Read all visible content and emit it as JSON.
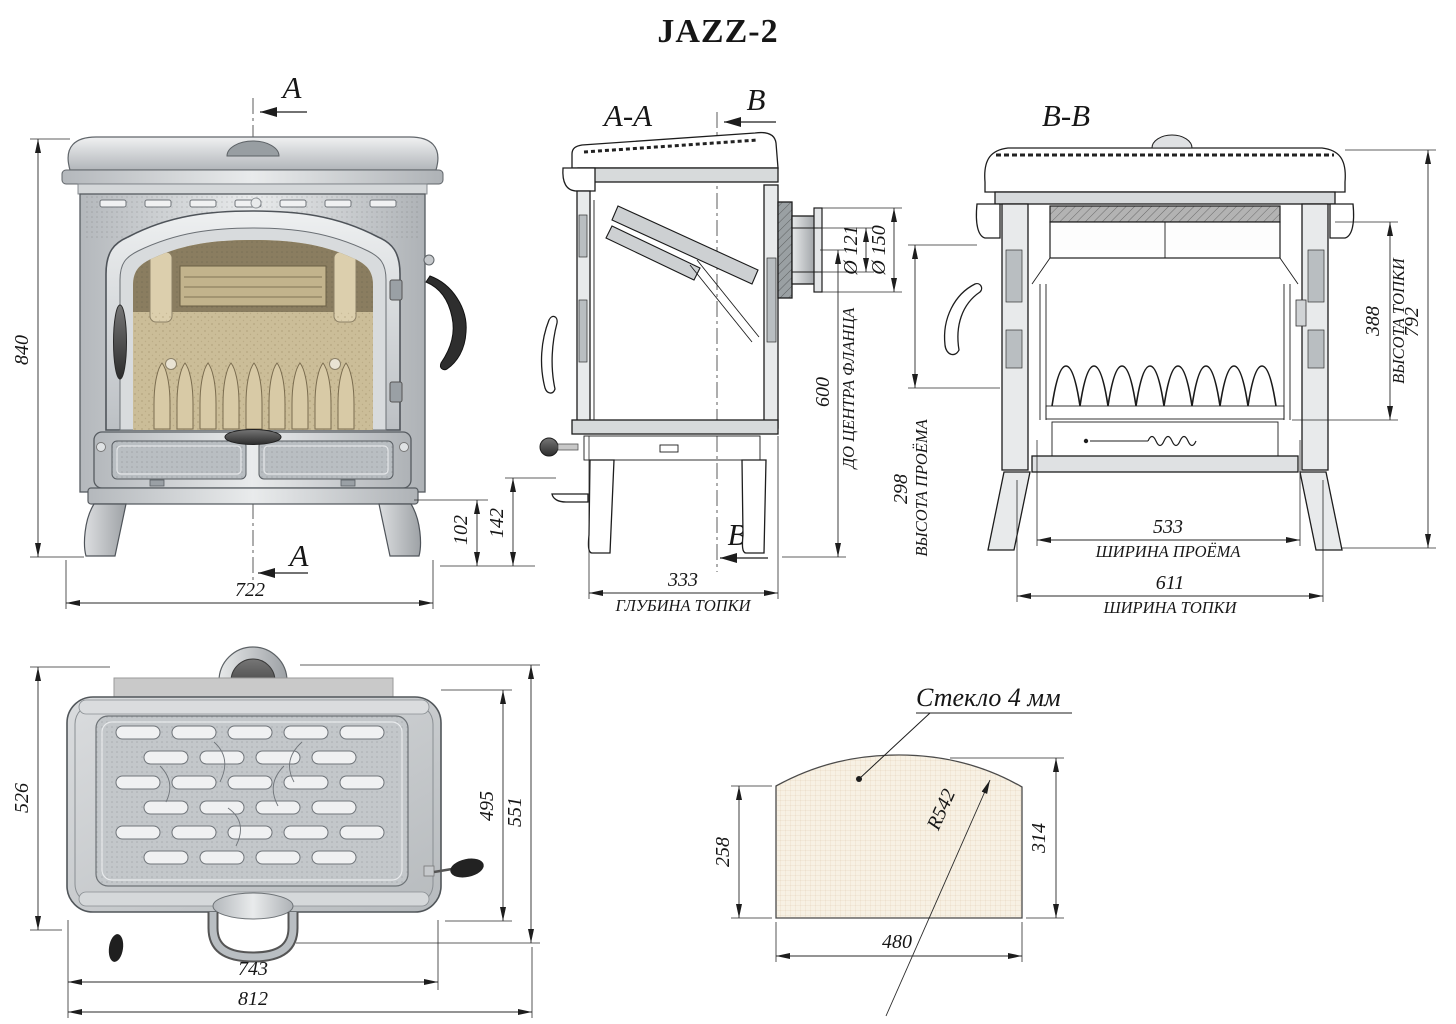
{
  "title": "JAZZ-2",
  "front": {
    "marker": "A",
    "dim_height": "840",
    "dim_width": "722",
    "dim_plinth": "102"
  },
  "aa": {
    "label": "A-A",
    "marker": "B",
    "dia_inner": "Ø 121",
    "dia_outer": "Ø 150",
    "h_flange": "600",
    "h_flange_cap": "ДО ЦЕНТРА ФЛАНЦА",
    "h_ash": "142",
    "depth": "333",
    "depth_cap": "ГЛУБИНА ТОПКИ"
  },
  "bb": {
    "label": "B-B",
    "open_h": "298",
    "open_h_cap": "ВЫСОТА ПРОЁМА",
    "open_w": "533",
    "open_w_cap": "ШИРИНА ПРОЁМА",
    "fb_w": "611",
    "fb_w_cap": "ШИРИНА ТОПКИ",
    "fb_h": "388",
    "fb_h_cap": "ВЫСОТА ТОПКИ",
    "body_h": "792"
  },
  "top": {
    "depth": "526",
    "body_depth": "495",
    "depth_handle": "551",
    "body_w": "743",
    "overall_w": "812"
  },
  "glass": {
    "label": "Стекло 4 мм",
    "side_h": "258",
    "full_h": "314",
    "width": "480",
    "radius": "R542"
  },
  "colors": {
    "line": "#1d1d1d",
    "glass_fill": "#f7f1e4",
    "firebrick": "#cfc1a0",
    "firebrick_dark": "#8a7d60",
    "hearth": "#cbbd98",
    "steel_light": "#e9ebec",
    "steel_dark": "#8e9397"
  }
}
